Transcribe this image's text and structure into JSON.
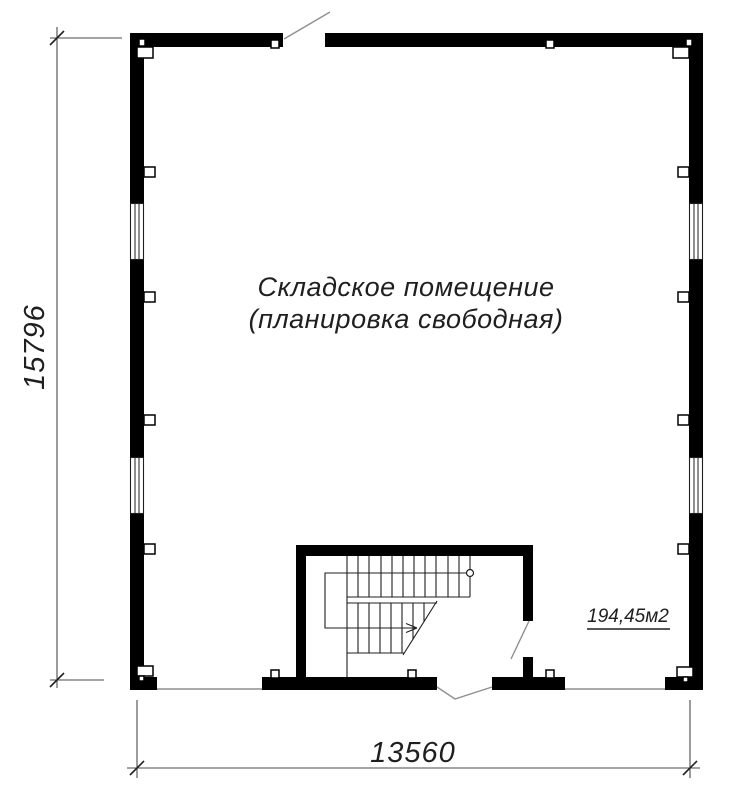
{
  "drawing": {
    "room_label_line1": "Складское помещение",
    "room_label_line2": "(планировка свободная)",
    "area_label": "194,45м2",
    "dim_height": "15796",
    "dim_width": "13560",
    "plan": {
      "room_type": "warehouse, free layout",
      "windows": 4,
      "top_wall_doors": 1,
      "bottom_wall_openings": 3,
      "staircase": "U-shaped switchback stair, bottom center"
    },
    "colors": {
      "wall": "#000000",
      "thin_line": "#1f1f1f",
      "opening_line": "#8f8f8f",
      "dimension": "#4a4a4a",
      "text": "#1f1f1f",
      "background": "#ffffff"
    }
  }
}
